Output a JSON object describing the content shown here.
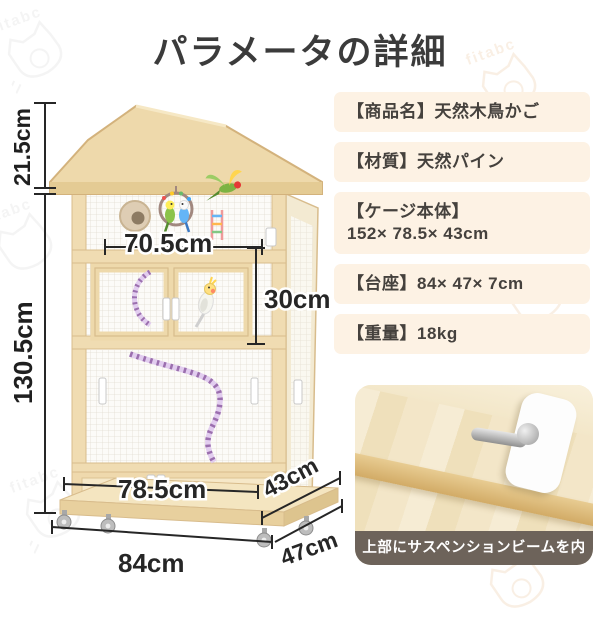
{
  "title": "パラメータの詳細",
  "watermark": {
    "brand": "fitabc"
  },
  "diagram": {
    "labels": {
      "roof_height": "21.5cm",
      "body_height": "130.5cm",
      "inner_width": "70.5cm",
      "door_height": "30cm",
      "drawer_width": "78.5cm",
      "top_depth": "43cm",
      "base_width": "84cm",
      "base_depth": "47cm"
    }
  },
  "specs": [
    {
      "line1": "【商品名】天然木鳥かご"
    },
    {
      "line1": "【材質】天然パイン"
    },
    {
      "line1": "【ケージ本体】",
      "line2": "152× 78.5× 43cm"
    },
    {
      "line1": "【台座】84× 47× 7cm"
    },
    {
      "line1": "【重量】18kg"
    }
  ],
  "inset": {
    "caption": "上部にサスペンションビームを内蔵"
  },
  "colors": {
    "wood": "#eed9ab",
    "wood_dark": "#d8bc8c",
    "spec_bg": "#fdf2e4",
    "caption_bg": "#6d635a",
    "text_dark": "#3b3b3b"
  }
}
